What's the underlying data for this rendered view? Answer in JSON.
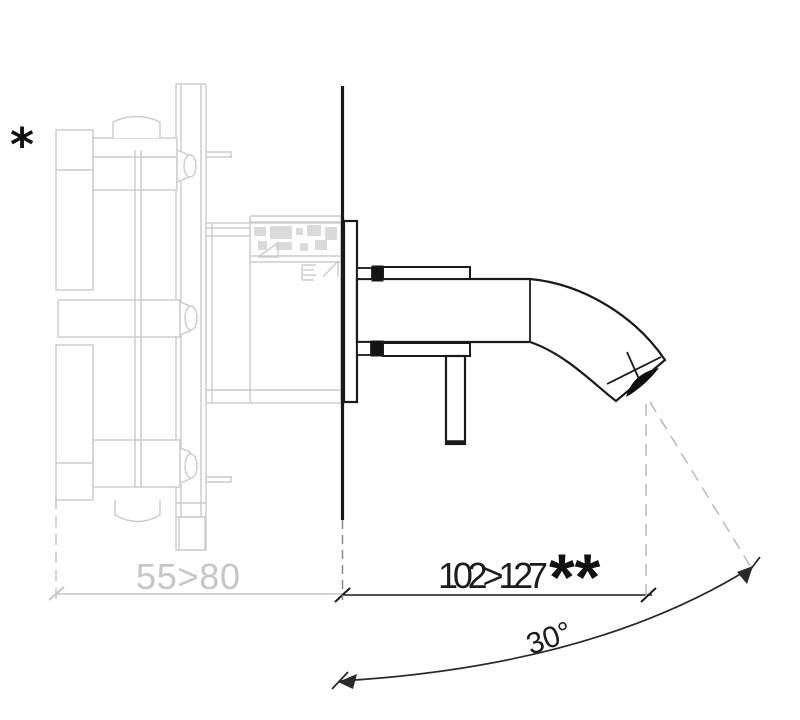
{
  "drawing": {
    "type": "technical-installation-diagram",
    "labels": {
      "wall_note": "*",
      "depth_range": "55>80",
      "spout_projection": "102>127",
      "projection_note": "**",
      "spout_angle": "30°"
    },
    "colors": {
      "trim_line": "#1a1a1a",
      "ghost_line": "#cbcbcb",
      "ghost_text": "#c6c6c6",
      "background": "#ffffff"
    }
  }
}
